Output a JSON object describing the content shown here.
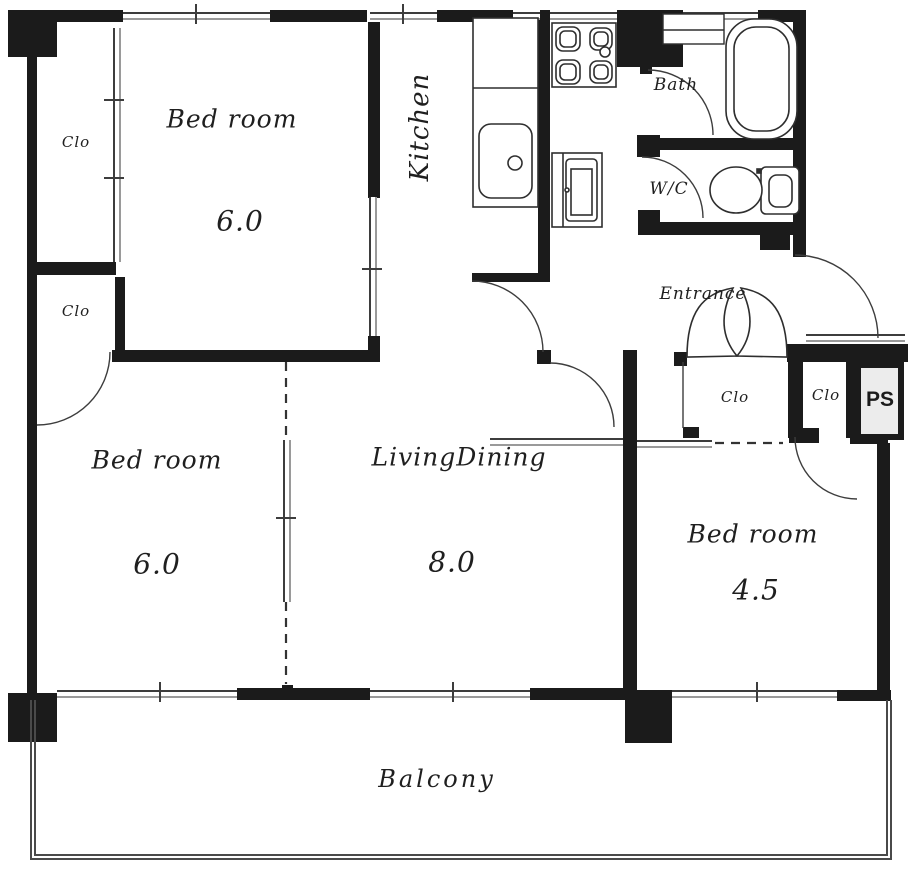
{
  "rooms": {
    "bedroom_top": {
      "label": "Bed room",
      "size": "6.0"
    },
    "bedroom_left": {
      "label": "Bed room",
      "size": "6.0"
    },
    "bedroom_right": {
      "label": "Bed room",
      "size": "4.5"
    },
    "living": {
      "label": "LivingDining",
      "size": "8.0"
    },
    "kitchen": {
      "label": "Kitchen"
    },
    "bath": {
      "label": "Bath"
    },
    "wc": {
      "label": "W/C"
    },
    "entrance": {
      "label": "Entrance"
    },
    "balcony": {
      "label": "Balcony"
    }
  },
  "storage": {
    "closet1": {
      "label": "Clo"
    },
    "closet2": {
      "label": "Clo"
    },
    "closet3": {
      "label": "Clo"
    },
    "closet4": {
      "label": "Clo"
    },
    "pipe_shaft": {
      "label": "PS"
    }
  },
  "colors": {
    "wall": "#1b1b1b",
    "line": "#3d3d3d",
    "ps_fill": "#ececec",
    "background": "#ffffff",
    "text": "#1f1f1f"
  }
}
